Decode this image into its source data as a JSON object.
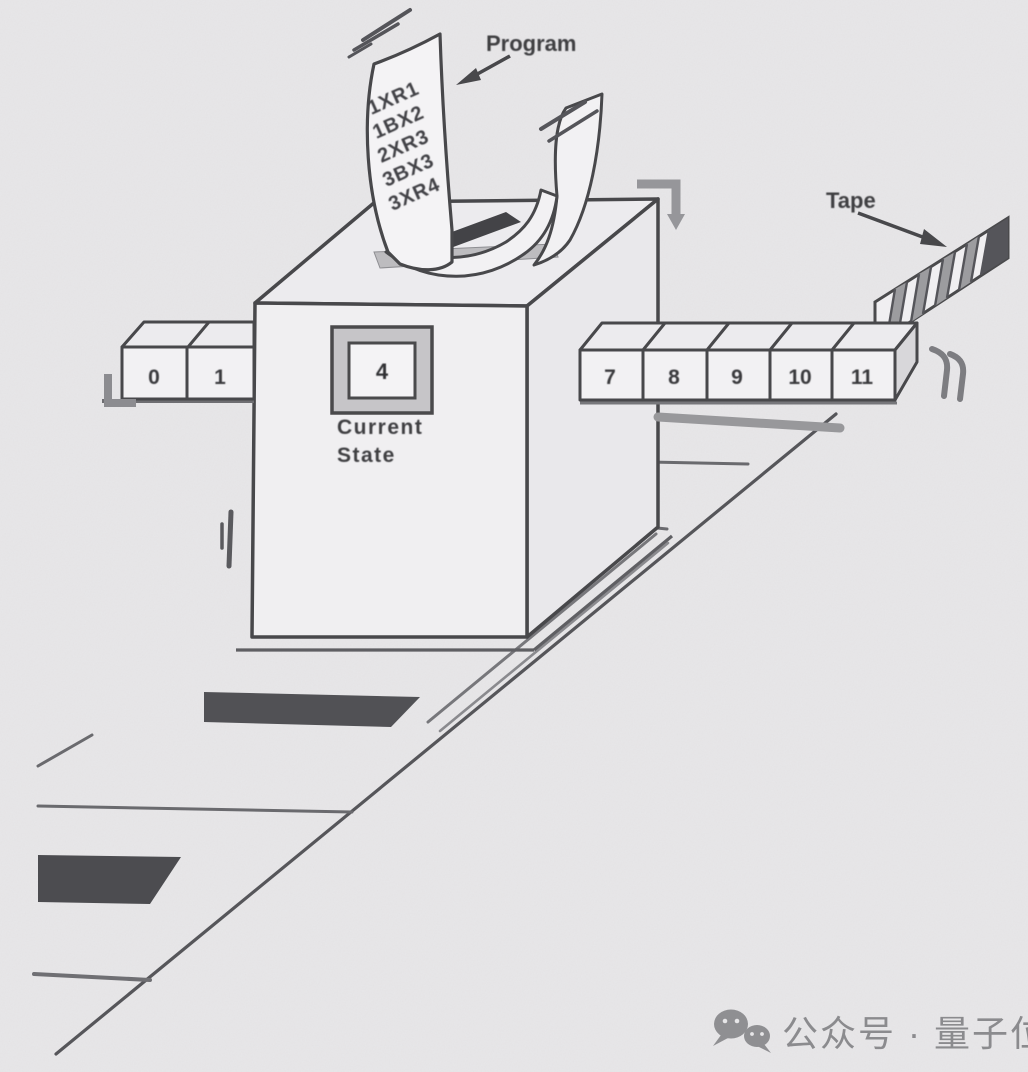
{
  "labels": {
    "program": "Program",
    "tape": "Tape",
    "current_state_line1": "Current",
    "current_state_line2": "State"
  },
  "machine": {
    "current_state_value": "4",
    "program_lines": [
      "1XR1",
      "1BX2",
      "2XR3",
      "3BX3",
      "3XR4"
    ]
  },
  "tape": {
    "left_cells": [
      "0",
      "1"
    ],
    "right_cells": [
      "7",
      "8",
      "9",
      "10",
      "11"
    ]
  },
  "watermark": {
    "icon": "wechat-icon",
    "text": "公众号 · 量子位"
  },
  "colors": {
    "background": "#e7e6e8",
    "ink": "#48484b",
    "paper": "#f2f1f3",
    "shadow_dark": "#4e4e52",
    "soft_gray": "#98989b",
    "watermark_gray": "#8b8b8e"
  }
}
